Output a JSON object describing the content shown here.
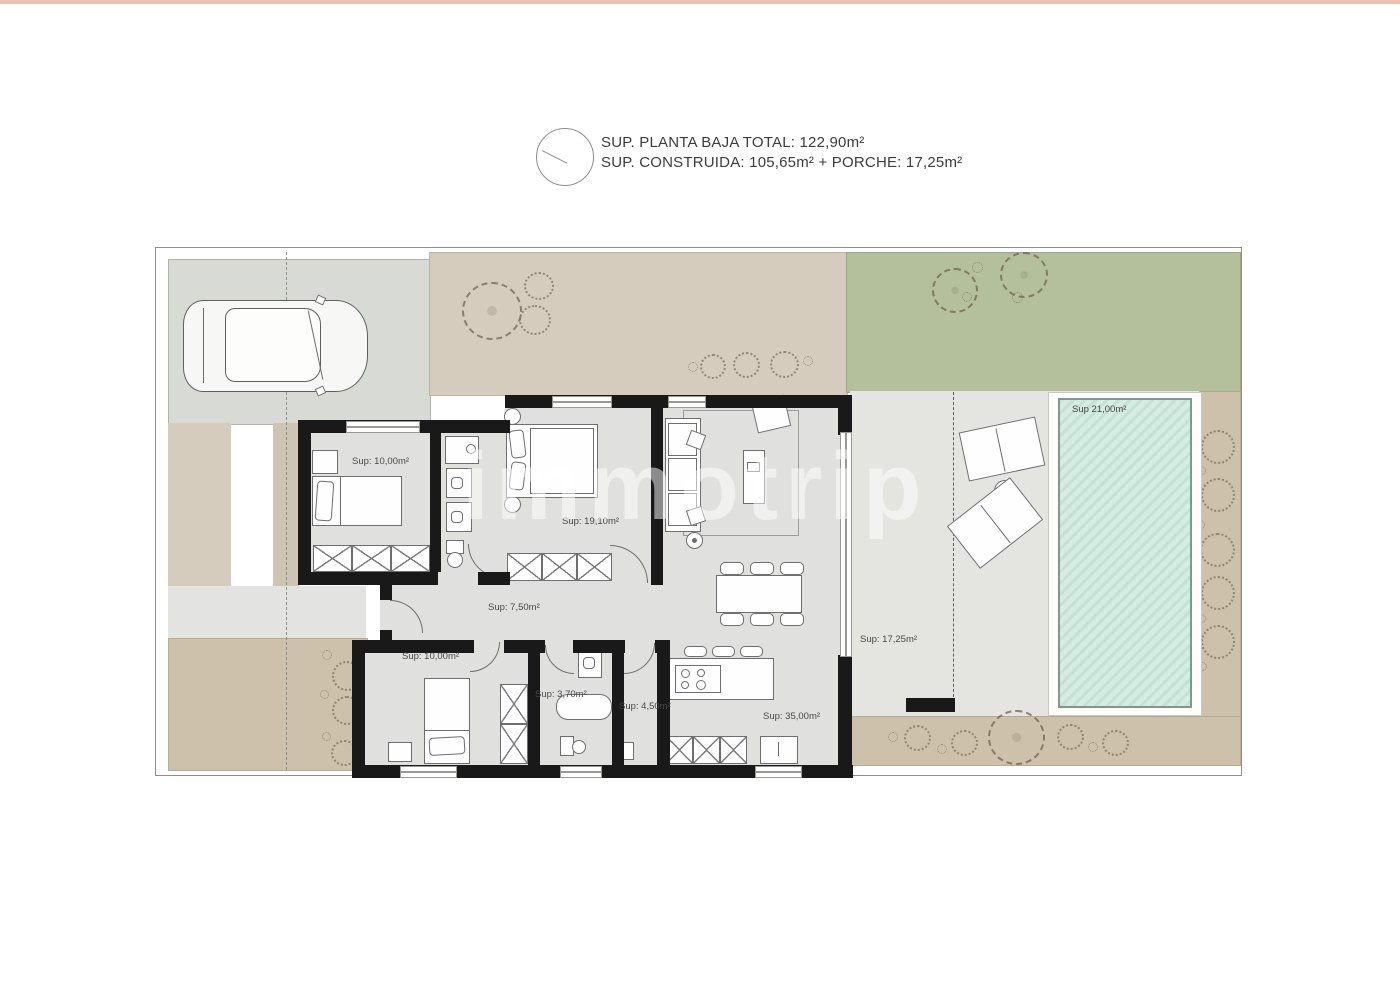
{
  "header": {
    "line1": "SUP. PLANTA BAJA TOTAL: 122,90m²",
    "line2": "SUP. CONSTRUIDA: 105,65m² + PORCHE: 17,25m²"
  },
  "watermark": "immotrip",
  "rooms": {
    "bedroom1": "Sup: 10,00m²",
    "master_bedroom": "Sup: 19,10m²",
    "hallway": "Sup: 7,50m²",
    "bedroom2": "Sup: 10,00m²",
    "bathroom2": "Sup: 3,70m²",
    "utility": "Sup: 4,50m²",
    "kitchen_living": "Sup: 35,00m²",
    "porch": "Sup: 17,25m²",
    "pool": "Sup 21,00m²"
  },
  "colors": {
    "lawn": "#b4c09c",
    "pool_water": "#d5ece2",
    "sand_garden": "#d6ccbd",
    "tan_border": "#cec1ab",
    "driveway": "#d8dad5",
    "terrace": "#e4e4e1",
    "floor": "#e0e1de",
    "wall": "#191919",
    "page_top_border": "#edbfb2"
  }
}
